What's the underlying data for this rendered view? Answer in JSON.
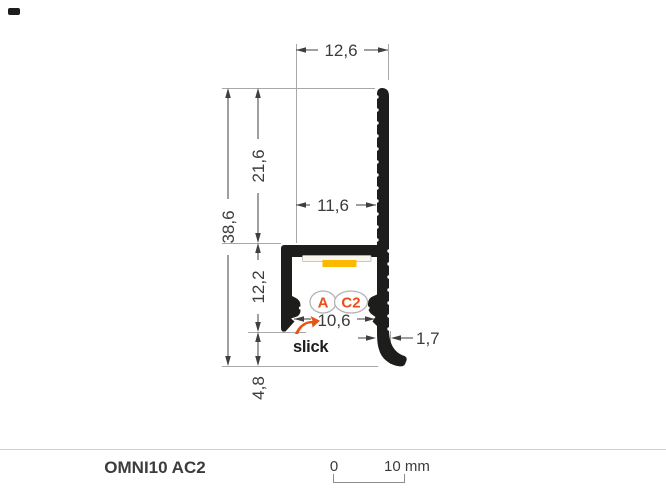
{
  "colors": {
    "profile_black": "#1d1d1b",
    "accent_red": "#e94e1b",
    "led_yellow": "#fbba00",
    "dimension_line": "#3f3f3f",
    "extension_line": "#a8a8a8"
  },
  "drawing": {
    "dims": {
      "top_width": "12,6",
      "upper_height": "21,6",
      "fin_offset": "11,6",
      "total_height": "38,6",
      "channel_height": "12,2",
      "opening_width": "10,6",
      "wall_thickness": "1,7",
      "foot_height": "4,8"
    },
    "badges": [
      {
        "label": "A"
      },
      {
        "label": "C2"
      }
    ],
    "brand": "slick"
  },
  "footer": {
    "title": "OMNI10 AC2",
    "scale": {
      "zero": "0",
      "label": "10 mm"
    }
  }
}
